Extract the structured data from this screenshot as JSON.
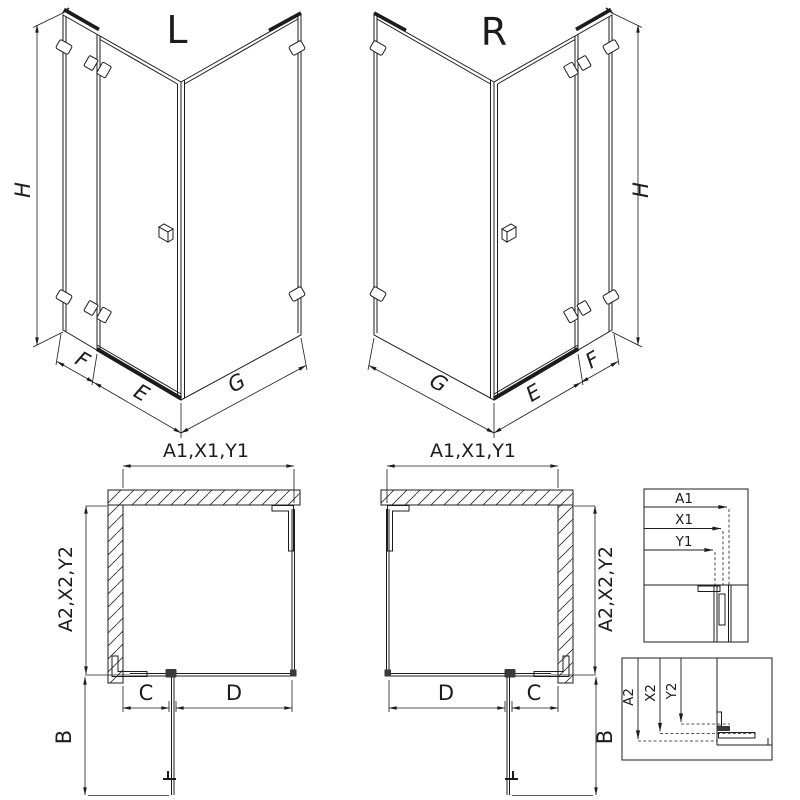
{
  "colors": {
    "background": "#ffffff",
    "line": "#1c1c1c",
    "dark_fill": "#3a3a3a"
  },
  "iso_left": {
    "variant_label": "L",
    "dim_height": "H",
    "dim_f": "F",
    "dim_e": "E",
    "dim_g": "G"
  },
  "iso_right": {
    "variant_label": "R",
    "dim_height": "H",
    "dim_g": "G",
    "dim_e": "E",
    "dim_f": "F"
  },
  "plan_left": {
    "dim_width_top": "A1,X1,Y1",
    "dim_depth_side": "A2,X2,Y2",
    "dim_c": "C",
    "dim_d": "D",
    "dim_b": "B"
  },
  "plan_right": {
    "dim_width_top": "A1,X1,Y1",
    "dim_depth_side": "A2,X2,Y2",
    "dim_d": "D",
    "dim_c": "C",
    "dim_b": "B"
  },
  "detail_width": {
    "dim_a1": "A1",
    "dim_x1": "X1",
    "dim_y1": "Y1"
  },
  "detail_depth": {
    "dim_a2": "A2",
    "dim_x2": "X2",
    "dim_y2": "Y2"
  }
}
